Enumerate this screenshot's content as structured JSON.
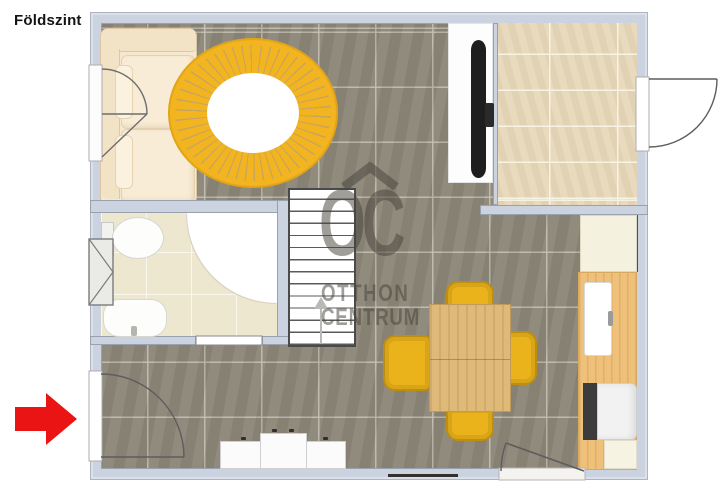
{
  "page": {
    "floor_label": "Földszint"
  },
  "watermark": {
    "initials": "OC",
    "name_line1": "OTTHON",
    "name_line2": "CENTRUM",
    "text_color": "rgba(72,69,60,0.52)"
  },
  "indicators": {
    "entrance_arrow": {
      "icon": "red-right-arrow",
      "color": "#eb1414",
      "direction": "right"
    },
    "stairs_direction": {
      "icon": "up-arrow",
      "color": "#b9b9b5"
    }
  },
  "colors": {
    "wall": "#ccd3e0",
    "gray_tile_floor": "#8d8779",
    "beige_tile_floor": "#e7d8bb",
    "bathroom_floor": "#eee7cf",
    "rug_yellow": "#f2b41f",
    "chair_yellow": "#eab31c",
    "table_wood": "#dfb977",
    "counter_wood": "#eec07a",
    "sofa_cream": "#f6e8cf"
  }
}
